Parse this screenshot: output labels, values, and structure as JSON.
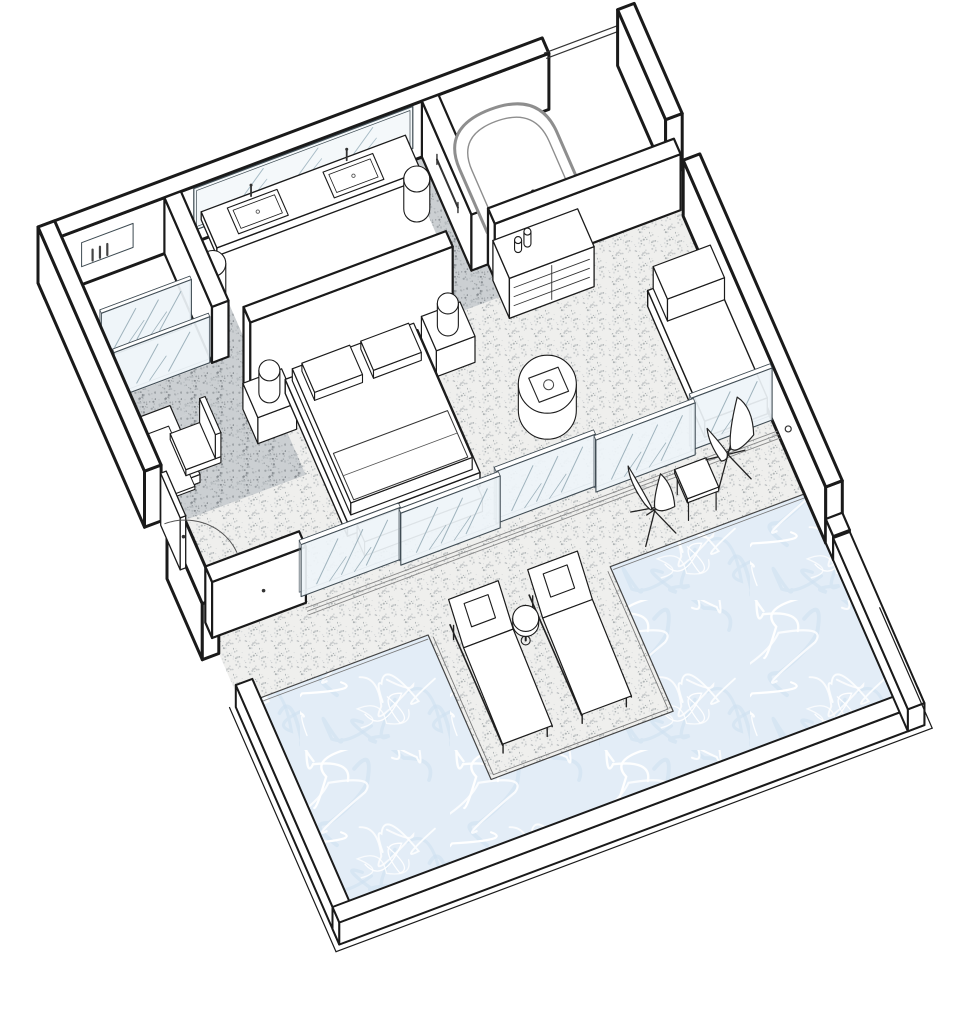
{
  "meta": {
    "title": "Suite with private pool – axonometric floor plan",
    "type": "axonometric-floor-plan"
  },
  "colors": {
    "background": "#ffffff",
    "line": "#1a1a1a",
    "line_soft": "#555555",
    "tub_line": "#8e8e8e",
    "glass_fill": "#eef4f8",
    "glass_frame": "#414d55",
    "glass_hatch": "#9fb3bd",
    "mirror_fill": "#f4f8fa",
    "mirror_hatch": "#a8bcc6",
    "floor_light_base": "#efefed",
    "floor_light_dots": [
      "#c3c7c8",
      "#a9aeb0",
      "#d7dadb"
    ],
    "floor_dark_base": "#cbcfd2",
    "floor_dark_dots": [
      "#9aa0a3",
      "#858b8f",
      "#b4babd"
    ],
    "water_base": "#e3edf7",
    "water_streak": "#ffffff",
    "water_shade": "#cddff0",
    "white": "#ffffff"
  },
  "projection": {
    "ox": 38,
    "oy": 283,
    "ux": 0.92,
    "uy": -0.345,
    "vx": 0.375,
    "vy": 0.86,
    "wall_h": 56
  },
  "scene": [
    {
      "t": "fl",
      "name": "bedroom-floor",
      "r": [
        18,
        145,
        630,
        420
      ],
      "f": "light"
    },
    {
      "t": "fl",
      "name": "walkway-floor",
      "r": [
        18,
        145,
        428,
        187
      ],
      "f": "dark"
    },
    {
      "t": "fl",
      "name": "walkway-left-strip",
      "r": [
        148,
        18,
        170,
        145
      ],
      "f": "dark"
    },
    {
      "t": "fl",
      "name": "walkway-right-strip",
      "r": [
        392,
        18,
        410,
        145
      ],
      "f": "dark"
    },
    {
      "t": "fl",
      "name": "walkway-passage",
      "r": [
        18,
        187,
        172,
        292
      ],
      "f": "dark"
    },
    {
      "t": "fl",
      "name": "terrace-deck",
      "r": [
        18,
        420,
        630,
        498
      ],
      "f": "light"
    },
    {
      "t": "fl",
      "name": "pool-deck-peninsula",
      "r": [
        221,
        498,
        419,
        666
      ],
      "f": "light"
    },
    {
      "t": "fl",
      "name": "pool-water",
      "pts": [
        [
          30,
          498
        ],
        [
          221,
          498
        ],
        [
          221,
          666
        ],
        [
          419,
          666
        ],
        [
          419,
          498
        ],
        [
          630,
          498
        ],
        [
          630,
          756
        ],
        [
          30,
          756
        ]
      ],
      "f": "water",
      "s": 1.2
    },
    {
      "t": "p3",
      "name": "peninsula-edge-line",
      "d": [
        [
          "M",
          225,
          502,
          0
        ],
        [
          "L",
          225,
          662,
          0
        ],
        [
          "L",
          415,
          662,
          0
        ],
        [
          "L",
          415,
          502,
          0
        ]
      ],
      "w": 0.9,
      "col": "#7a7a7a"
    },
    {
      "t": "l3",
      "name": "pool-edge-line",
      "a": [
        30,
        502,
        0
      ],
      "b": [
        219,
        502,
        0
      ],
      "w": 0.9,
      "col": "#7a7a7a"
    },
    {
      "t": "l3",
      "name": "pool-edge-line",
      "a": [
        421,
        502,
        0
      ],
      "b": [
        630,
        502,
        0
      ],
      "w": 0.9,
      "col": "#7a7a7a"
    },
    {
      "t": "pr",
      "name": "top-wall",
      "r": [
        0,
        0,
        548,
        18
      ],
      "h": 56,
      "sw": 3
    },
    {
      "t": "l3",
      "name": "lintel-line",
      "a": [
        548,
        6,
        46
      ],
      "b": [
        630,
        6,
        46
      ],
      "w": 1.2,
      "col": "#333333"
    },
    {
      "t": "l3",
      "name": "lintel-line",
      "a": [
        548,
        12,
        46
      ],
      "b": [
        630,
        12,
        46
      ],
      "w": 1.2,
      "col": "#333333"
    },
    {
      "t": "wr",
      "name": "vanity-mirror",
      "plane": "v",
      "at": 18,
      "a1": 162,
      "a2": 400,
      "z1": 12,
      "z2": 54,
      "f": "mirror",
      "hatch": 3,
      "inner": 3
    },
    {
      "t": "wr",
      "name": "shower-niche",
      "plane": "v",
      "at": 18,
      "a1": 40,
      "a2": 96,
      "z1": 18,
      "z2": 42,
      "f": "#ffffff",
      "inner": 0,
      "w": 1
    },
    {
      "t": "l3",
      "name": "niche-bottle",
      "a": [
        52,
        18,
        20
      ],
      "b": [
        52,
        18,
        31
      ],
      "w": 2.2,
      "col": "#444444"
    },
    {
      "t": "l3",
      "name": "niche-bottle",
      "a": [
        60,
        18,
        20
      ],
      "b": [
        60,
        18,
        31
      ],
      "w": 2.2,
      "col": "#444444"
    },
    {
      "t": "l3",
      "name": "niche-bottle",
      "a": [
        68,
        18,
        20
      ],
      "b": [
        68,
        18,
        31
      ],
      "w": 2.2,
      "col": "#444444"
    },
    {
      "t": "pr",
      "name": "vanity-counter",
      "r": [
        170,
        18,
        392,
        60
      ],
      "z": 20,
      "h": 8,
      "sw": 1.3
    },
    {
      "t": "sk",
      "name": "vanity-sink",
      "r": [
        196,
        24,
        250,
        54
      ],
      "z": 28
    },
    {
      "t": "sk",
      "name": "vanity-sink",
      "r": [
        300,
        24,
        354,
        54
      ],
      "z": 28
    },
    {
      "t": "cy",
      "name": "vanity-stool",
      "c": [
        159,
        76
      ],
      "r": 13,
      "h": 30
    },
    {
      "t": "cy",
      "name": "vanity-stool",
      "c": [
        384,
        68
      ],
      "r": 13,
      "h": 30
    },
    {
      "t": "pr",
      "name": "shower-partition-wall",
      "r": [
        130,
        18,
        148,
        145
      ],
      "h": 56,
      "sw": 2.2
    },
    {
      "t": "gl",
      "name": "shower-glass-panel",
      "r": [
        28,
        96,
        126,
        100
      ],
      "h": 46,
      "hatch": 3
    },
    {
      "t": "gl",
      "name": "shower-glass-front",
      "r": [
        24,
        140,
        128,
        144
      ],
      "h": 46,
      "hatch": 2
    },
    {
      "t": "pr",
      "name": "tub-partition-wall",
      "r": [
        410,
        18,
        428,
        150
      ],
      "h": 56,
      "sw": 2.2
    },
    {
      "t": "l3",
      "name": "towel-rail",
      "a": [
        410,
        58,
        32
      ],
      "b": [
        410,
        114,
        32
      ],
      "w": 2,
      "col": "#333333"
    },
    {
      "t": "l3",
      "name": "towel-rail-end",
      "a": [
        410,
        58,
        27
      ],
      "b": [
        410,
        58,
        37
      ],
      "w": 1.4,
      "col": "#333333"
    },
    {
      "t": "l3",
      "name": "towel-rail-end",
      "a": [
        410,
        114,
        27
      ],
      "b": [
        410,
        114,
        37
      ],
      "w": 1.4,
      "col": "#333333"
    },
    {
      "t": "wr",
      "name": "bathtub-front",
      "plane": "v",
      "at": 148,
      "a1": 428,
      "a2": 534,
      "z1": 0,
      "z2": 30,
      "f": "#ffffff",
      "col": "#8e8e8e",
      "w": 1.2
    },
    {
      "t": "p3",
      "name": "bathtub-rim",
      "d": [
        [
          "M",
          428,
          148,
          30
        ],
        [
          "L",
          428,
          74,
          30
        ],
        [
          "Q",
          428,
          26,
          30,
          481,
          26,
          30
        ],
        [
          "Q",
          534,
          26,
          30,
          534,
          74,
          30
        ],
        [
          "L",
          534,
          148,
          30
        ],
        [
          "Z"
        ]
      ],
      "f": "#ffffff",
      "col": "#8e8e8e",
      "w": 3
    },
    {
      "t": "p3",
      "name": "bathtub-inner",
      "d": [
        [
          "M",
          439,
          146,
          30
        ],
        [
          "L",
          439,
          80,
          30
        ],
        [
          "Q",
          439,
          40,
          30,
          481,
          40,
          30
        ],
        [
          "Q",
          523,
          40,
          30,
          523,
          80,
          30
        ],
        [
          "L",
          523,
          146,
          30
        ]
      ],
      "col": "#8e8e8e",
      "w": 1.4
    },
    {
      "t": "l3",
      "name": "tub-faucet",
      "a": [
        481,
        140,
        32
      ],
      "b": [
        481,
        140,
        45
      ],
      "w": 2,
      "col": "#333333"
    },
    {
      "t": "dt",
      "name": "tub-faucet-head",
      "p": [
        481,
        140,
        46
      ],
      "r": 2
    },
    {
      "t": "pr",
      "name": "right-wall-upper",
      "r": [
        630,
        0,
        648,
        128
      ],
      "h": 56,
      "sw": 3
    },
    {
      "t": "pr",
      "name": "right-wall",
      "r": [
        630,
        175,
        648,
        555
      ],
      "h": 56,
      "sw": 3
    },
    {
      "t": "pr",
      "name": "right-wall-step",
      "r": [
        630,
        555,
        648,
        575
      ],
      "h": 24,
      "sw": 2.2
    },
    {
      "t": "dt",
      "name": "wall-light",
      "p": [
        630,
        455,
        28
      ],
      "r": 3,
      "stroke": 1
    },
    {
      "t": "pr",
      "name": "dresser-back-wall",
      "r": [
        428,
        150,
        630,
        168
      ],
      "h": 56,
      "sw": 2.2
    },
    {
      "t": "pr",
      "name": "dresser",
      "r": [
        426,
        168,
        518,
        212
      ],
      "h": 40,
      "sw": 1.3
    },
    {
      "t": "l3",
      "name": "dresser-drawer-line",
      "a": [
        431,
        212,
        11
      ],
      "b": [
        513,
        212,
        11
      ],
      "w": 0.9,
      "col": "#333333"
    },
    {
      "t": "l3",
      "name": "dresser-drawer-line",
      "a": [
        431,
        212,
        20
      ],
      "b": [
        513,
        212,
        20
      ],
      "w": 0.9,
      "col": "#333333"
    },
    {
      "t": "l3",
      "name": "dresser-drawer-line",
      "a": [
        431,
        212,
        29
      ],
      "b": [
        513,
        212,
        29
      ],
      "w": 0.9,
      "col": "#333333"
    },
    {
      "t": "l3",
      "name": "dresser-divider",
      "a": [
        472,
        212,
        3
      ],
      "b": [
        472,
        212,
        37
      ],
      "w": 0.9,
      "col": "#333333"
    },
    {
      "t": "cy",
      "name": "dresser-bottle",
      "c": [
        446,
        186
      ],
      "r": 3.5,
      "z": 40,
      "h": 9
    },
    {
      "t": "cy",
      "name": "dresser-bottle",
      "c": [
        457,
        184
      ],
      "r": 3.5,
      "z": 40,
      "h": 12
    },
    {
      "t": "pr",
      "name": "headboard-wall",
      "r": [
        148,
        185,
        368,
        203
      ],
      "h": 84,
      "sw": 2.2
    },
    {
      "t": "pr",
      "name": "nightstand",
      "r": [
        140,
        203,
        182,
        243
      ],
      "h": 26,
      "sw": 1.2
    },
    {
      "t": "cy",
      "name": "table-lamp",
      "c": [
        161,
        222
      ],
      "r": 10.5,
      "z": 26,
      "h": 22
    },
    {
      "t": "pr",
      "name": "nightstand",
      "r": [
        334,
        203,
        376,
        243
      ],
      "h": 26,
      "sw": 1.2
    },
    {
      "t": "cy",
      "name": "table-lamp",
      "c": [
        355,
        222
      ],
      "r": 10.5,
      "z": 26,
      "h": 22
    },
    {
      "t": "pr",
      "name": "bed-platform",
      "r": [
        186,
        203,
        330,
        369
      ],
      "h": 14,
      "sw": 1.4
    },
    {
      "t": "pr",
      "name": "bed-mattress",
      "r": [
        192,
        207,
        324,
        363
      ],
      "z": 14,
      "h": 12,
      "sw": 1.2
    },
    {
      "t": "pr",
      "name": "bed-pillow",
      "r": [
        200,
        213,
        252,
        247
      ],
      "z": 26,
      "h": 8,
      "sw": 1.1
    },
    {
      "t": "pr",
      "name": "bed-pillow",
      "r": [
        264,
        213,
        316,
        247
      ],
      "z": 26,
      "h": 8,
      "sw": 1.1
    },
    {
      "t": "p3",
      "name": "bed-duvet-outline",
      "d": [
        [
          "M",
          196,
          307,
          26
        ],
        [
          "L",
          320,
          307,
          26
        ],
        [
          "L",
          320,
          361,
          26
        ],
        [
          "L",
          196,
          361,
          26
        ],
        [
          "Z"
        ]
      ],
      "w": 1,
      "col": "#333333"
    },
    {
      "t": "l3",
      "name": "bed-duvet-fold",
      "a": [
        196,
        333,
        26
      ],
      "b": [
        320,
        333,
        26
      ],
      "w": 0.8,
      "col": "#555555"
    },
    {
      "t": "pr",
      "name": "bed-foot-bench",
      "r": [
        194,
        375,
        322,
        395
      ],
      "h": 14,
      "sw": 1.2
    },
    {
      "t": "pr",
      "name": "desk",
      "r": [
        18,
        200,
        62,
        280
      ],
      "z": 20,
      "h": 8,
      "sw": 1.2
    },
    {
      "t": "pr",
      "name": "desk-shelf",
      "r": [
        22,
        206,
        58,
        276
      ],
      "z": 11,
      "h": 3,
      "sw": 1
    },
    {
      "t": "pr",
      "name": "desk-chair-seat",
      "r": [
        54,
        220,
        92,
        262
      ],
      "z": 14,
      "h": 6,
      "sw": 1.1
    },
    {
      "t": "pr",
      "name": "desk-chair-back",
      "r": [
        86,
        220,
        92,
        262
      ],
      "z": 20,
      "h": 24,
      "sw": 1.1
    },
    {
      "t": "pr",
      "name": "left-wall-upper",
      "r": [
        0,
        0,
        18,
        284
      ],
      "h": 56,
      "sw": 3
    },
    {
      "t": "pr",
      "name": "left-wall-lower",
      "r": [
        0,
        344,
        18,
        438
      ],
      "h": 56,
      "sw": 3
    },
    {
      "t": "pr",
      "name": "entry-door-leaf",
      "r": [
        16,
        288,
        22,
        340
      ],
      "h": 52,
      "sw": 1.3
    },
    {
      "t": "dt",
      "name": "door-handle",
      "p": [
        22,
        334,
        26
      ],
      "r": 1.8
    },
    {
      "t": "ar",
      "name": "door-swing-arc",
      "c": [
        20,
        344
      ],
      "r": 56,
      "w": 1,
      "col": "#555555"
    },
    {
      "t": "cy",
      "name": "ottoman",
      "c": [
        424,
        318
      ],
      "r": 29,
      "h": 26
    },
    {
      "t": "p3",
      "name": "ottoman-tray",
      "d": [
        [
          "M",
          409,
          305,
          26
        ],
        [
          "L",
          441,
          305,
          26
        ],
        [
          "L",
          441,
          333,
          26
        ],
        [
          "L",
          409,
          333,
          26
        ],
        [
          "Z"
        ]
      ],
      "f": "#ffffff",
      "w": 1.1,
      "col": "#222222"
    },
    {
      "t": "dc",
      "name": "ottoman-cup",
      "c": [
        425,
        319
      ],
      "z": 26,
      "r": 5,
      "stroke": 1
    },
    {
      "t": "pr",
      "name": "daybed-sofa",
      "r": [
        560,
        252,
        628,
        404
      ],
      "h": 16,
      "sw": 1.4
    },
    {
      "t": "pr",
      "name": "daybed-headrest",
      "r": [
        566,
        252,
        628,
        290
      ],
      "z": 16,
      "h": 22,
      "sw": 1.2
    },
    {
      "t": "pr",
      "name": "terrace-return-wall",
      "r": [
        18,
        402,
        120,
        420
      ],
      "h": 56,
      "sw": 2.2
    },
    {
      "t": "dt",
      "name": "door-handle",
      "p": [
        74,
        420,
        28
      ],
      "r": 1.8
    },
    {
      "t": "gl",
      "name": "sliding-glass-door",
      "r": [
        118,
        407,
        226,
        412
      ],
      "h": 52,
      "hatch": 3
    },
    {
      "t": "gl",
      "name": "sliding-glass-door",
      "r": [
        330,
        407,
        438,
        412
      ],
      "h": 52,
      "hatch": 3
    },
    {
      "t": "gl",
      "name": "sliding-glass-door",
      "r": [
        542,
        407,
        630,
        412
      ],
      "h": 52,
      "hatch": 2
    },
    {
      "t": "gl",
      "name": "sliding-glass-door",
      "r": [
        224,
        413,
        332,
        418
      ],
      "h": 52,
      "hatch": 3
    },
    {
      "t": "gl",
      "name": "sliding-glass-door",
      "r": [
        436,
        413,
        544,
        418
      ],
      "h": 52,
      "hatch": 3
    },
    {
      "t": "l3",
      "name": "door-track",
      "a": [
        118,
        425,
        0
      ],
      "b": [
        630,
        425,
        0
      ],
      "w": 0.9,
      "col": "#8a8a8a"
    },
    {
      "t": "l3",
      "name": "door-track",
      "a": [
        118,
        429,
        0
      ],
      "b": [
        630,
        429,
        0
      ],
      "w": 0.9,
      "col": "#8a8a8a"
    },
    {
      "t": "l3",
      "name": "door-track",
      "a": [
        118,
        433,
        0
      ],
      "b": [
        630,
        433,
        0
      ],
      "w": 0.9,
      "col": "#8a8a8a"
    },
    {
      "t": "bf",
      "name": "butterfly-chair",
      "c": [
        478,
        472
      ],
      "dir": 1
    },
    {
      "t": "lt",
      "name": "terrace-side-table",
      "c": [
        526,
        466
      ],
      "s": 17,
      "h": 20
    },
    {
      "t": "bf",
      "name": "butterfly-chair",
      "c": [
        568,
        444
      ],
      "dir": -1
    },
    {
      "t": "pr",
      "name": "pool-coping-left",
      "r": [
        12,
        498,
        30,
        774
      ],
      "h": 22,
      "sw": 2
    },
    {
      "t": "pr",
      "name": "pool-coping-bottom",
      "r": [
        12,
        756,
        648,
        774
      ],
      "h": 22,
      "sw": 2
    },
    {
      "t": "pr",
      "name": "pool-coping-right",
      "r": [
        630,
        575,
        648,
        774
      ],
      "h": 22,
      "sw": 2
    },
    {
      "t": "l3",
      "name": "pool-outer-step",
      "a": [
        6,
        496,
        0
      ],
      "b": [
        6,
        780,
        0
      ],
      "w": 1.2,
      "col": "#1a1a1a"
    },
    {
      "t": "l3",
      "name": "pool-outer-step",
      "a": [
        6,
        780,
        0
      ],
      "b": [
        654,
        780,
        0
      ],
      "w": 1.2,
      "col": "#1a1a1a"
    },
    {
      "t": "l3",
      "name": "pool-outer-step",
      "a": [
        654,
        780,
        0
      ],
      "b": [
        654,
        640,
        0
      ],
      "w": 1.2,
      "col": "#1a1a1a"
    },
    {
      "t": "lg",
      "name": "sun-lounger",
      "r": [
        240,
        506,
        294,
        650
      ]
    },
    {
      "t": "lg",
      "name": "sun-lounger",
      "r": [
        326,
        506,
        380,
        650
      ]
    },
    {
      "t": "dk",
      "name": "pool-side-table",
      "c": [
        310,
        540
      ],
      "r": 13
    }
  ]
}
